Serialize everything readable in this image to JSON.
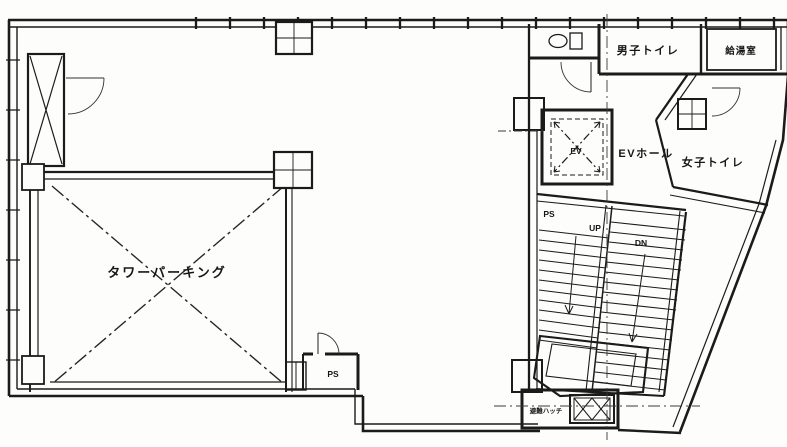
{
  "drawing": {
    "type": "architectural-floor-plan",
    "labels": {
      "tower_parking": "タワーパーキング",
      "mens_toilet": "男子トイレ",
      "kitchenette": "給湯室",
      "womens_toilet": "女子トイレ",
      "ev": "EV",
      "ev_hall": "EVホール",
      "ps_stair": "PS",
      "up": "UP",
      "dn": "DN",
      "ps_room": "PS",
      "evac_hatch": "避難ハッチ"
    },
    "colors": {
      "ink": "#1b1b1b",
      "paper": "#fdfdfb"
    }
  }
}
